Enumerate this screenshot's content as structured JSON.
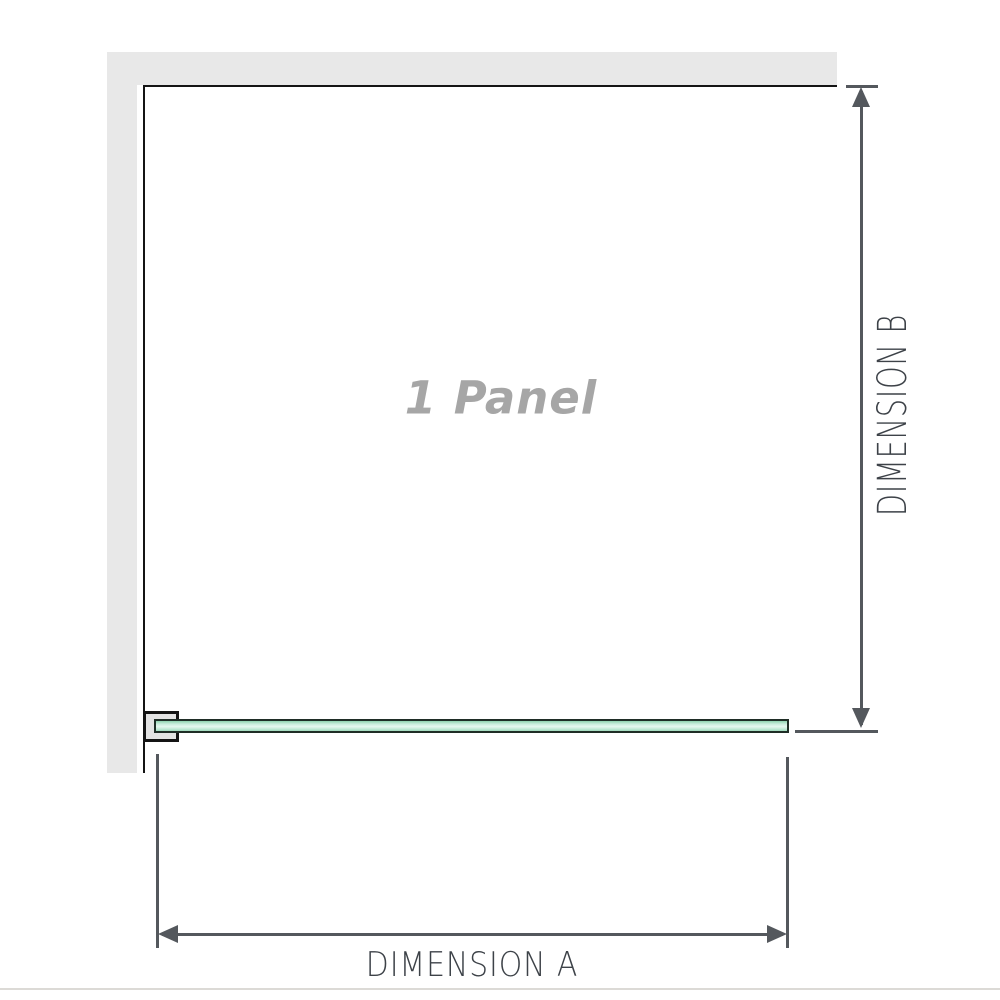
{
  "diagram": {
    "panel_label": "1 Panel",
    "dimensions": {
      "a_label": "DIMENSION A",
      "b_label": "DIMENSION B"
    },
    "colors": {
      "wall_fill": "#e8e8e8",
      "frame_stroke": "#141414",
      "bracket_fill": "#e3e3e3",
      "glass_stroke": "#1f2d26",
      "glass_fill_light": "#e6f7ef",
      "glass_fill_dark": "#8ed1ae",
      "dimension_stroke": "#54585d",
      "dimension_text": "#3d4248",
      "panel_text": "#a6a6a6"
    }
  }
}
